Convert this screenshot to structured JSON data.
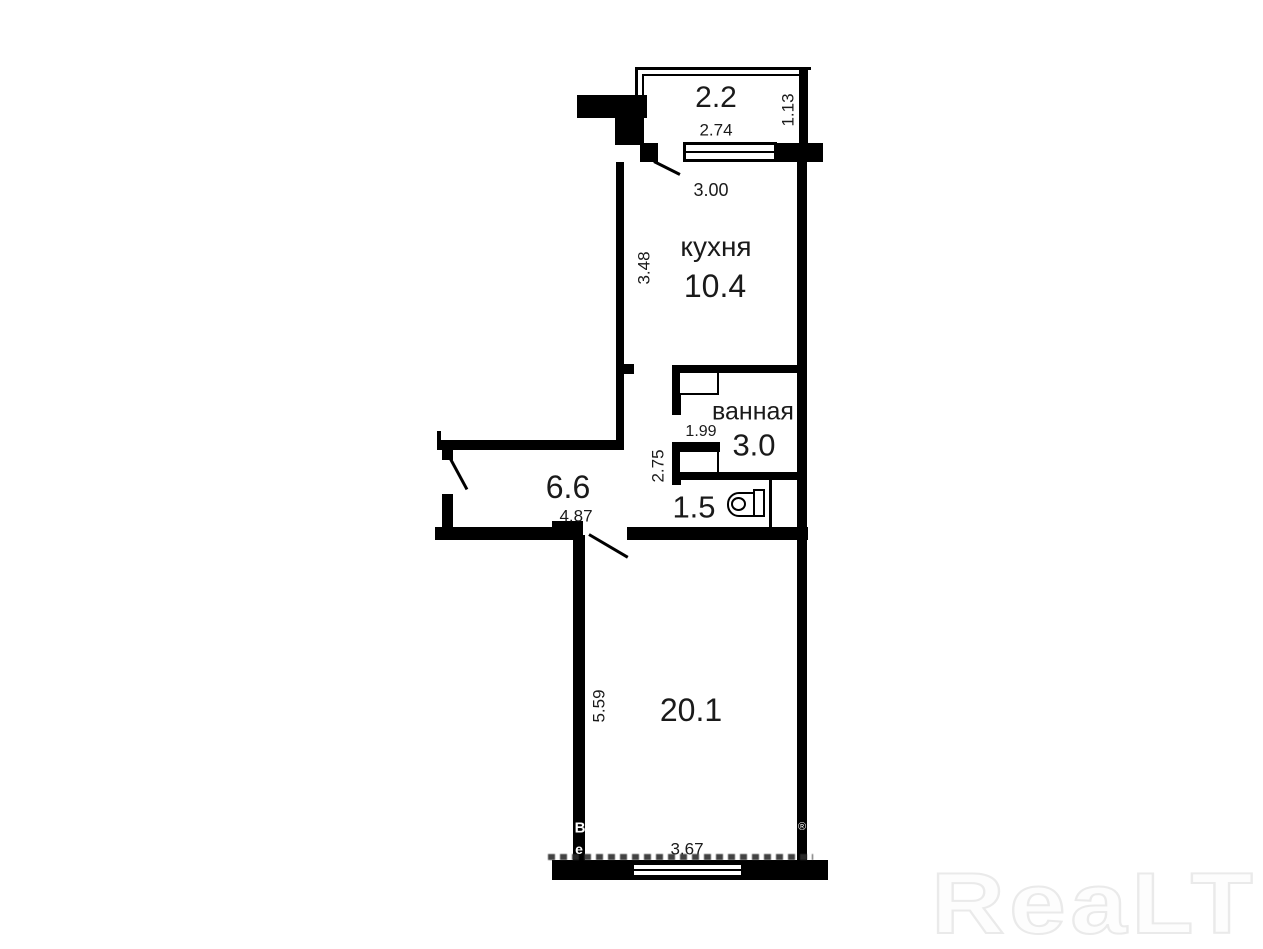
{
  "floor_plan": {
    "balcony": {
      "area": "2.2",
      "width": "2.74",
      "depth": "1.13"
    },
    "kitchen": {
      "name": "кухня",
      "area": "10.4",
      "door_width": "3.00",
      "height": "3.48"
    },
    "bathroom": {
      "name": "ванная",
      "area": "3.0",
      "width": "1.99",
      "corridor_height": "2.75"
    },
    "toilet": {
      "area": "1.5"
    },
    "hallway": {
      "area": "6.6",
      "width": "4.87"
    },
    "living_room": {
      "area": "20.1",
      "height": "5.59",
      "window_width": "3.67"
    }
  },
  "watermark": {
    "logo_text": "ReaLT",
    "registered_symbol": "®",
    "wall_fragment_top": "B",
    "wall_fragment_bottom": "e"
  },
  "colors": {
    "wall": "#000000",
    "text": "#1a1a1a",
    "logo_outline": "#eaeaea"
  }
}
